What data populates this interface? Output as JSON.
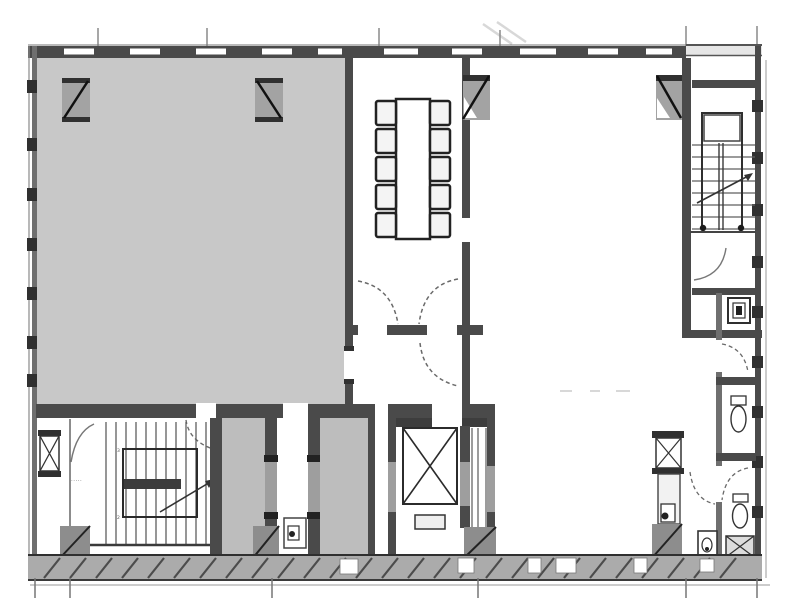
{
  "colors": {
    "bg": "#ffffff",
    "wall": "#4a4a4a",
    "wall_mid": "#6f6f6f",
    "wall_light": "#9e9e9e",
    "line": "#303030",
    "line_soft": "#6a6a6a",
    "shade": "#c8c8c8",
    "shade_dark": "#bdbdbd",
    "column": "#a3a3a3",
    "column_dark": "#8d8d8d",
    "band": "#ababab",
    "faint": "#d8d8d8"
  },
  "labels": {
    "stair_label": "·····",
    "stair_mark_upper": "3",
    "stair_mark_lower": "2"
  },
  "rooms": [
    {
      "name": "large-shaded-room",
      "shaded": true
    },
    {
      "name": "meeting-room",
      "shaded": false
    },
    {
      "name": "large-open-room",
      "shaded": false
    },
    {
      "name": "stairwell-bottom-left",
      "shaded": false
    },
    {
      "name": "stairwell-top-right",
      "shaded": false
    },
    {
      "name": "elevator-core",
      "shaded": false
    },
    {
      "name": "service-shafts",
      "shaded": true
    },
    {
      "name": "wc-strip",
      "shaded": false
    }
  ],
  "fixtures": {
    "elevator_cab": "x-crossed box",
    "pipe_shaft": "small x-crossed box",
    "duct": "cross-hatched box",
    "toilet": "wc pan",
    "basin": "small sink",
    "conference_table": "rectangular table with 10 chairs"
  }
}
